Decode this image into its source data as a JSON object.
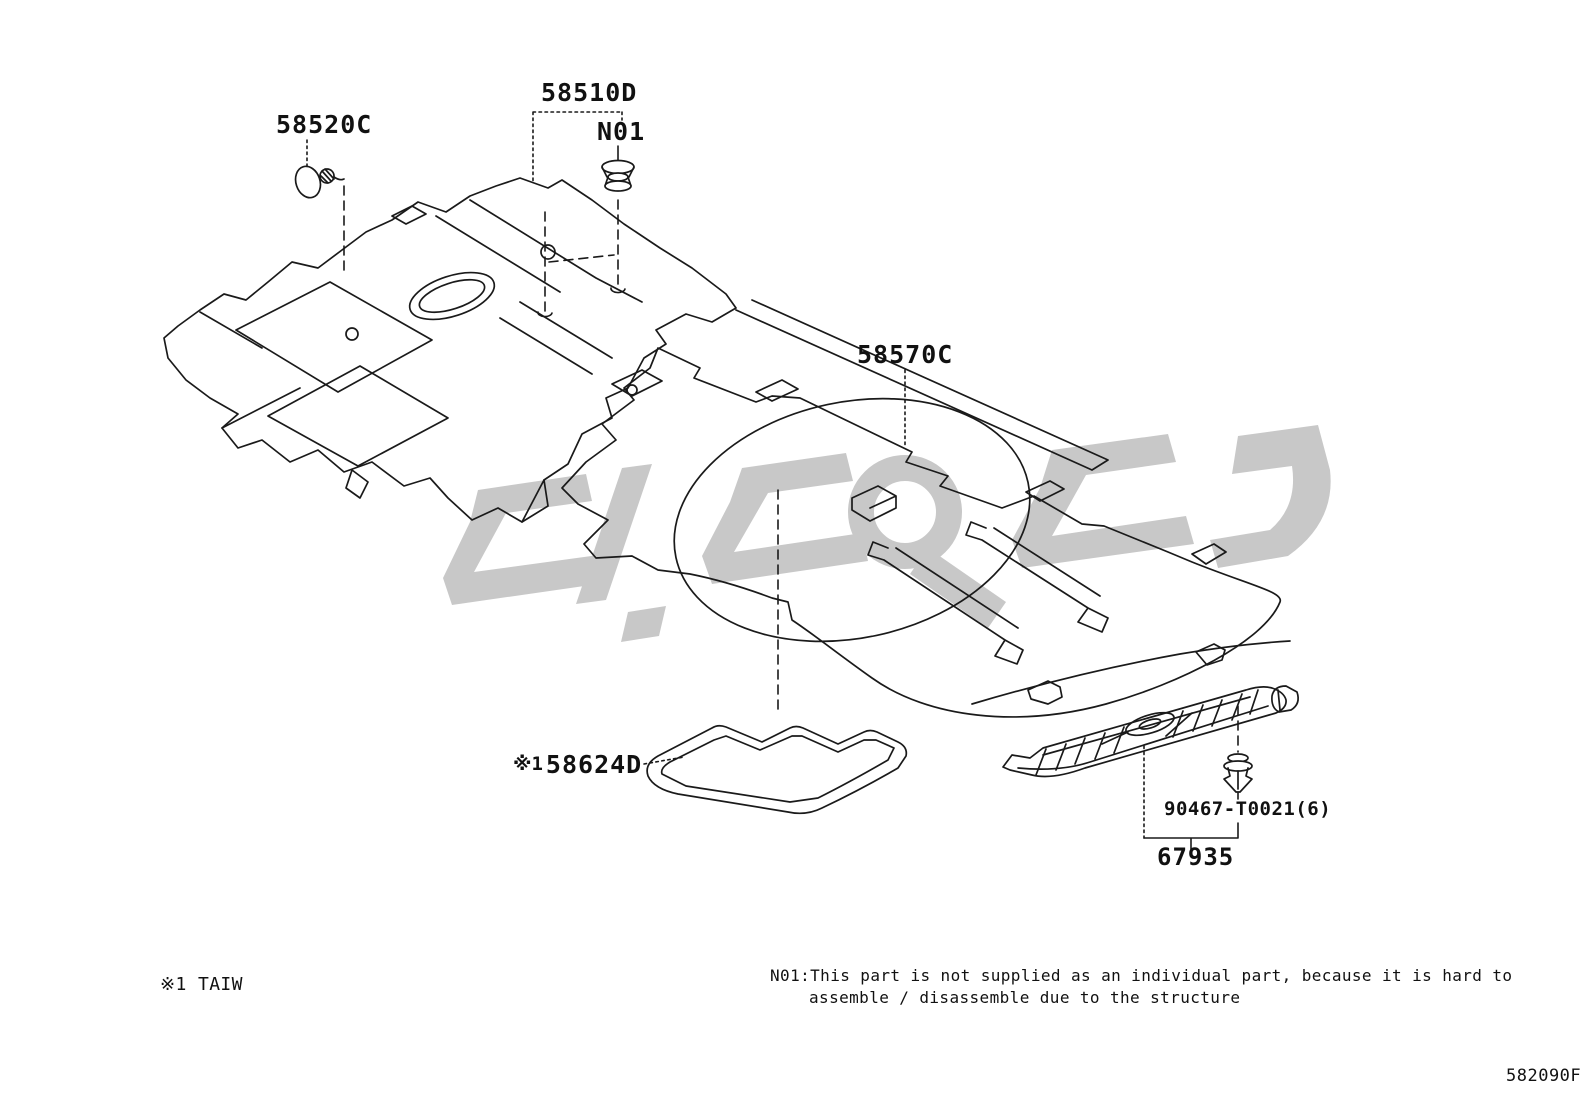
{
  "diagram": {
    "figure_code": "582090F",
    "parts": {
      "front_carpet_label": "58510D",
      "front_clip_label": "58520C",
      "grommet_label": "N01",
      "rear_carpet_label": "58570C",
      "pad_note_ref": "※1",
      "pad_label": "58624D",
      "rear_clip_label": "90467-T0021(6)",
      "scuff_plate_label": "67935"
    },
    "footnotes": {
      "ref1": "※1 TAIW",
      "n01_line1": "N01:This part is not supplied as an individual part, because it is hard to",
      "n01_line2": "assemble / disassemble due to the structure"
    },
    "colors": {
      "line": "#1a1a1a",
      "watermark": "#c8c8c8",
      "background": "#ffffff"
    }
  }
}
